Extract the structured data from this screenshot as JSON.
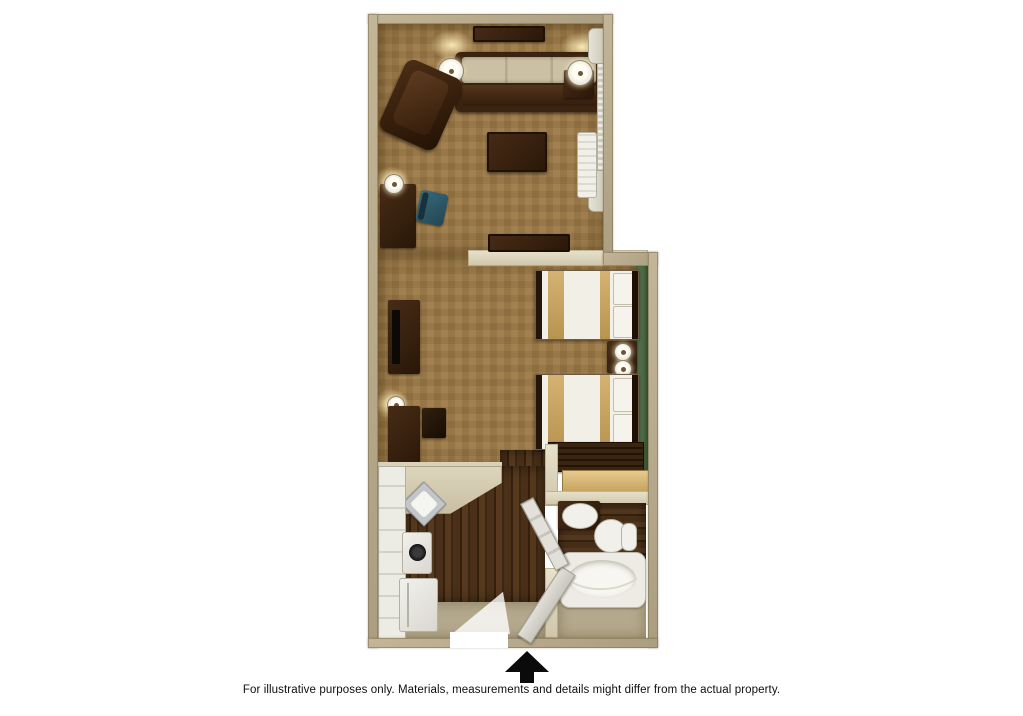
{
  "page": {
    "background": "#ffffff",
    "disclaimer": "For illustrative purposes only.  Materials, measurements and details might differ from the actual property.",
    "entry_arrow_icon": "up-arrow-icon"
  },
  "palette": {
    "outer_wall": "#b8ab8f",
    "inner_partition_wall": "#e5dec8",
    "carpet_floor": "#9d7a47",
    "kitchen_bath_wood_floor": "#46301b",
    "entry_floor_tan": "#b5a98d",
    "accent_wall_green": "#4a6743",
    "furniture_dark_wood": "#33200f",
    "bedding_white": "#f2efe7",
    "bedding_tan_runner": "#c8a865",
    "fixtures_white": "#f1f0ea",
    "desk_chair_teal": "#2f5a6a",
    "arrow_black": "#0b0b0b"
  },
  "floorplan": {
    "type": "hotel-studio-suite-top-view",
    "rooms": [
      "living-area",
      "bedroom-area",
      "kitchen",
      "bathroom",
      "closet",
      "entry"
    ],
    "furniture_and_fixtures": [
      "wall-shelf",
      "sofa",
      "table-lamp",
      "side-table",
      "recliner-chair",
      "coffee-table",
      "window-with-curtains",
      "ac-unit",
      "desk",
      "desk-chair",
      "wall-lamp",
      "media-credenza",
      "tv-console",
      "television",
      "side-table",
      "stool",
      "bed",
      "bed",
      "nightstand",
      "bedside-lamp",
      "bedside-lamp",
      "dresser",
      "closet-shelf",
      "kitchen-counter",
      "corner-sink",
      "stove",
      "refrigerator",
      "vanity-sink",
      "toilet",
      "bathtub",
      "shower-curtain-rod",
      "entry-door",
      "bathroom-door"
    ]
  }
}
